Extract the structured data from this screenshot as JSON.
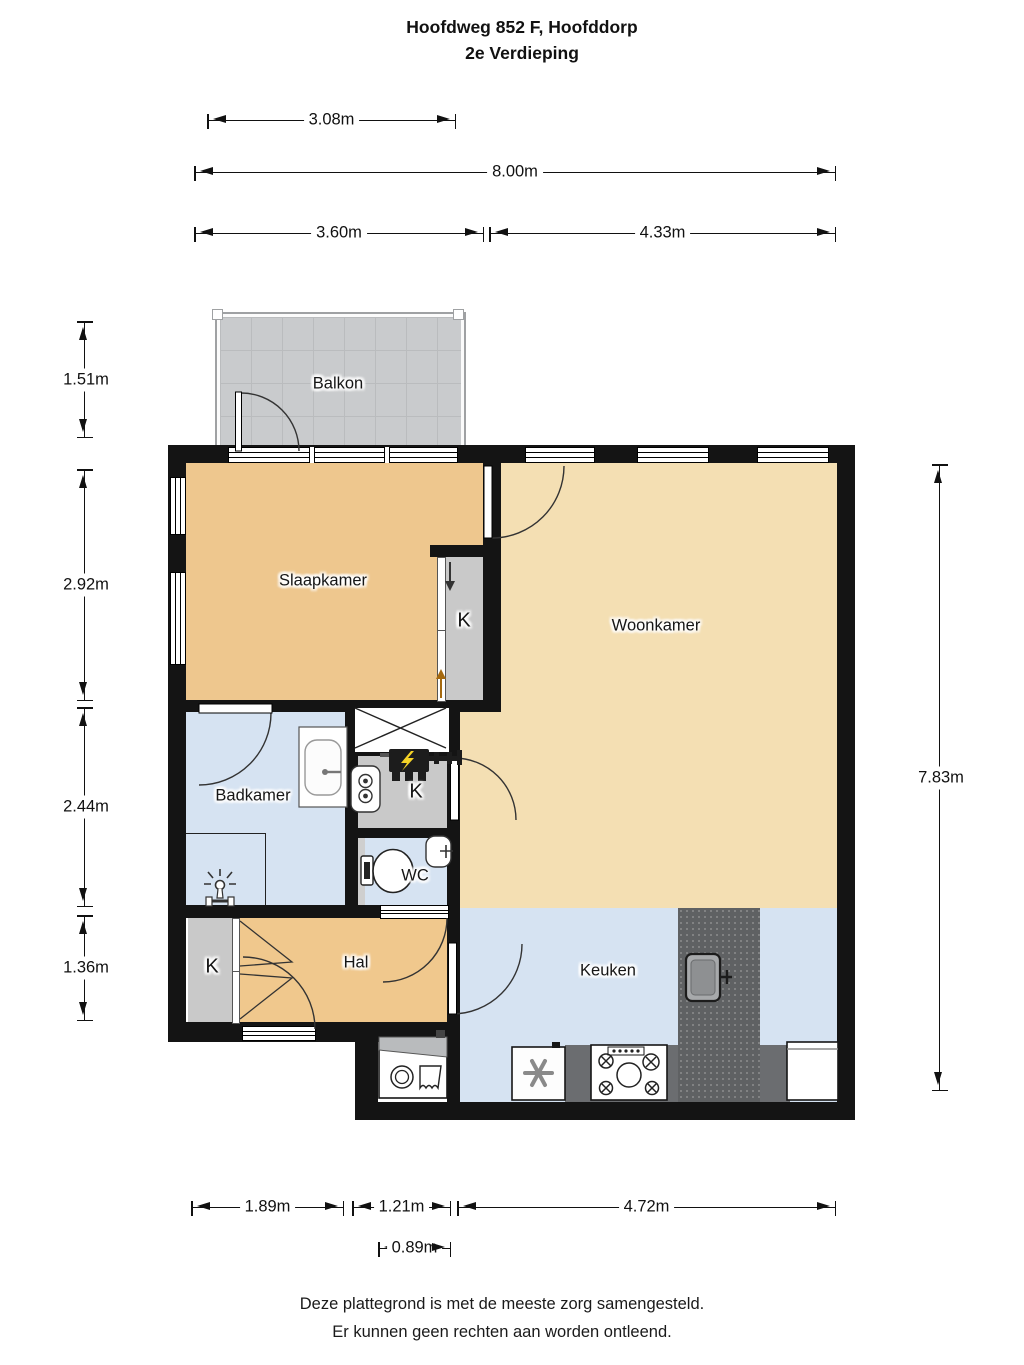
{
  "title": {
    "line1": "Hoofdweg 852 F, Hoofddorp",
    "line2": "2e Verdieping"
  },
  "rooms": {
    "balkon": "Balkon",
    "slaapkamer": "Slaapkamer",
    "woonkamer": "Woonkamer",
    "badkamer": "Badkamer",
    "wc": "WC",
    "hal": "Hal",
    "keuken": "Keuken",
    "kast_slaapkamer": "K",
    "kast_techniek": "K",
    "kast_hal": "K"
  },
  "dimensions": {
    "top": [
      "3.08m",
      "8.00m",
      "3.60m",
      "4.33m"
    ],
    "left": [
      "1.51m",
      "2.92m",
      "2.44m",
      "1.36m"
    ],
    "right": [
      "7.83m"
    ],
    "bottom": [
      "1.89m",
      "1.21m",
      "4.72m",
      "0.89m"
    ]
  },
  "footer": {
    "line1": "Deze plattegrond is met de meeste zorg samengesteld.",
    "line2": "Er kunnen geen rechten aan worden ontleend."
  },
  "colors": {
    "wall": "#141414",
    "bedroom_hall_floor": "#eec78e",
    "living_floor": "#f4dfb3",
    "wet_room_floor": "#d6e3f2",
    "closet_gray": "#c9c9c9",
    "balcony_gray": "#c9cbcd",
    "counter_dark": "#5f6163",
    "meter_bolt_yellow": "#f5d327"
  },
  "fixtures": [
    "balcony-door",
    "bedroom-door",
    "bathroom-door",
    "bathroom-sink",
    "shower-head",
    "duct-cross",
    "electric-meter",
    "boiler",
    "closet-door",
    "toilet",
    "fountain-sink",
    "wc-door",
    "front-door",
    "hall-closet-doors",
    "hall-door",
    "kitchen-island-sink",
    "fridge",
    "stove",
    "dishwasher",
    "washing-machine"
  ]
}
